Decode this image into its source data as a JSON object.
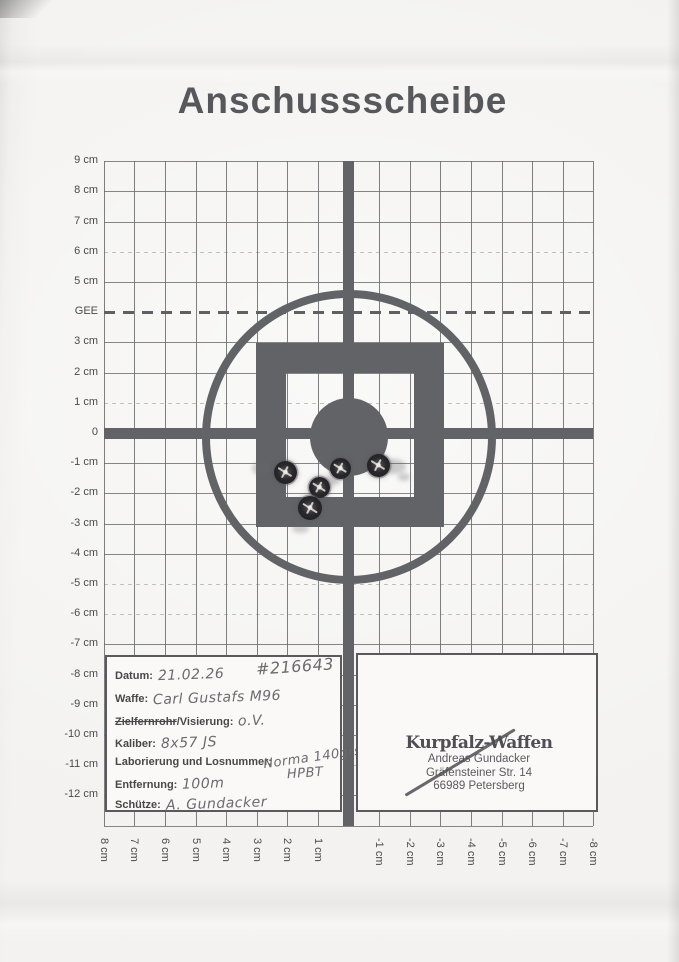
{
  "title": "Anschussscheibe",
  "axes": {
    "y_labels": [
      {
        "label": "9 cm",
        "cm": 9
      },
      {
        "label": "8 cm",
        "cm": 8
      },
      {
        "label": "7 cm",
        "cm": 7
      },
      {
        "label": "6 cm",
        "cm": 6
      },
      {
        "label": "5 cm",
        "cm": 5
      },
      {
        "label": "GEE",
        "cm": 4
      },
      {
        "label": "3 cm",
        "cm": 3
      },
      {
        "label": "2 cm",
        "cm": 2
      },
      {
        "label": "1 cm",
        "cm": 1
      },
      {
        "label": "0",
        "cm": 0
      },
      {
        "label": "-1 cm",
        "cm": -1
      },
      {
        "label": "-2 cm",
        "cm": -2
      },
      {
        "label": "-3 cm",
        "cm": -3
      },
      {
        "label": "-4 cm",
        "cm": -4
      },
      {
        "label": "-5 cm",
        "cm": -5
      },
      {
        "label": "-6 cm",
        "cm": -6
      },
      {
        "label": "-7 cm",
        "cm": -7
      },
      {
        "label": "-8 cm",
        "cm": -8
      },
      {
        "label": "-9 cm",
        "cm": -9
      },
      {
        "label": "-10 cm",
        "cm": -10
      },
      {
        "label": "-11 cm",
        "cm": -11
      },
      {
        "label": "-12 cm",
        "cm": -12
      }
    ],
    "x_labels": [
      {
        "label": "8 cm",
        "cm": 8
      },
      {
        "label": "7 cm",
        "cm": 7
      },
      {
        "label": "6 cm",
        "cm": 6
      },
      {
        "label": "5 cm",
        "cm": 5
      },
      {
        "label": "4 cm",
        "cm": 4
      },
      {
        "label": "3 cm",
        "cm": 3
      },
      {
        "label": "2 cm",
        "cm": 2
      },
      {
        "label": "1 cm",
        "cm": 1
      },
      {
        "label": "-1 cm",
        "cm": -1
      },
      {
        "label": "-2 cm",
        "cm": -2
      },
      {
        "label": "-3 cm",
        "cm": -3
      },
      {
        "label": "-4 cm",
        "cm": -4
      },
      {
        "label": "-5 cm",
        "cm": -5
      },
      {
        "label": "-6 cm",
        "cm": -6
      },
      {
        "label": "-7 cm",
        "cm": -7
      },
      {
        "label": "-8 cm",
        "cm": -8
      }
    ],
    "gee_label": "GEE",
    "faint_rows": [
      6,
      1,
      -5,
      -6,
      -11
    ]
  },
  "shots": [
    {
      "cm_x": 2.1,
      "cm_y": -1.3,
      "px": [
        285,
        472
      ],
      "d": 23
    },
    {
      "cm_x": 0.3,
      "cm_y": -1.1,
      "px": [
        340,
        468
      ],
      "d": 21
    },
    {
      "cm_x": -1.0,
      "cm_y": -1.0,
      "px": [
        378,
        465
      ],
      "d": 23
    },
    {
      "cm_x": 1.0,
      "cm_y": -1.8,
      "px": [
        319,
        487
      ],
      "d": 21
    },
    {
      "cm_x": 1.3,
      "cm_y": -2.4,
      "px": [
        310,
        508
      ],
      "d": 24
    }
  ],
  "smudges": [
    {
      "px": [
        262,
        468
      ],
      "w": 20,
      "h": 13
    },
    {
      "px": [
        394,
        466
      ],
      "w": 24,
      "h": 15
    },
    {
      "px": [
        404,
        477
      ],
      "w": 12,
      "h": 8
    },
    {
      "px": [
        331,
        481
      ],
      "w": 15,
      "h": 10
    },
    {
      "px": [
        300,
        528
      ],
      "w": 17,
      "h": 9
    }
  ],
  "form": {
    "ref_number": "#216643",
    "fields": [
      {
        "label": "Datum:",
        "value": "21.02.26"
      },
      {
        "label": "Waffe:",
        "value": "Carl Gustafs M96"
      },
      {
        "label_struck": "Zielfernrohr",
        "label_rest": "/Visierung:",
        "value": "o.V."
      },
      {
        "label": "Kaliber:",
        "value": "8x57 JS"
      },
      {
        "label": "Laborierung und Losnummer:",
        "value": "Norma 140grs.",
        "value_line2": "HPBT"
      },
      {
        "label": "Entfernung:",
        "value": "100m"
      },
      {
        "label": "Schütze:",
        "value": "A. Gundacker"
      }
    ]
  },
  "stamp": {
    "line1": "Kurpfalz-Waffen",
    "line2": "Andreas Gundacker",
    "line3": "Gräfensteiner Str. 14",
    "line4": "66989 Petersberg"
  },
  "colors": {
    "print": "#616366",
    "bullet_hole": "#29282c",
    "paper": "#f1f0ee",
    "printed_text": "#48484b",
    "handwriting": "#6a6a6f",
    "stamp_ink": "#55555b"
  }
}
